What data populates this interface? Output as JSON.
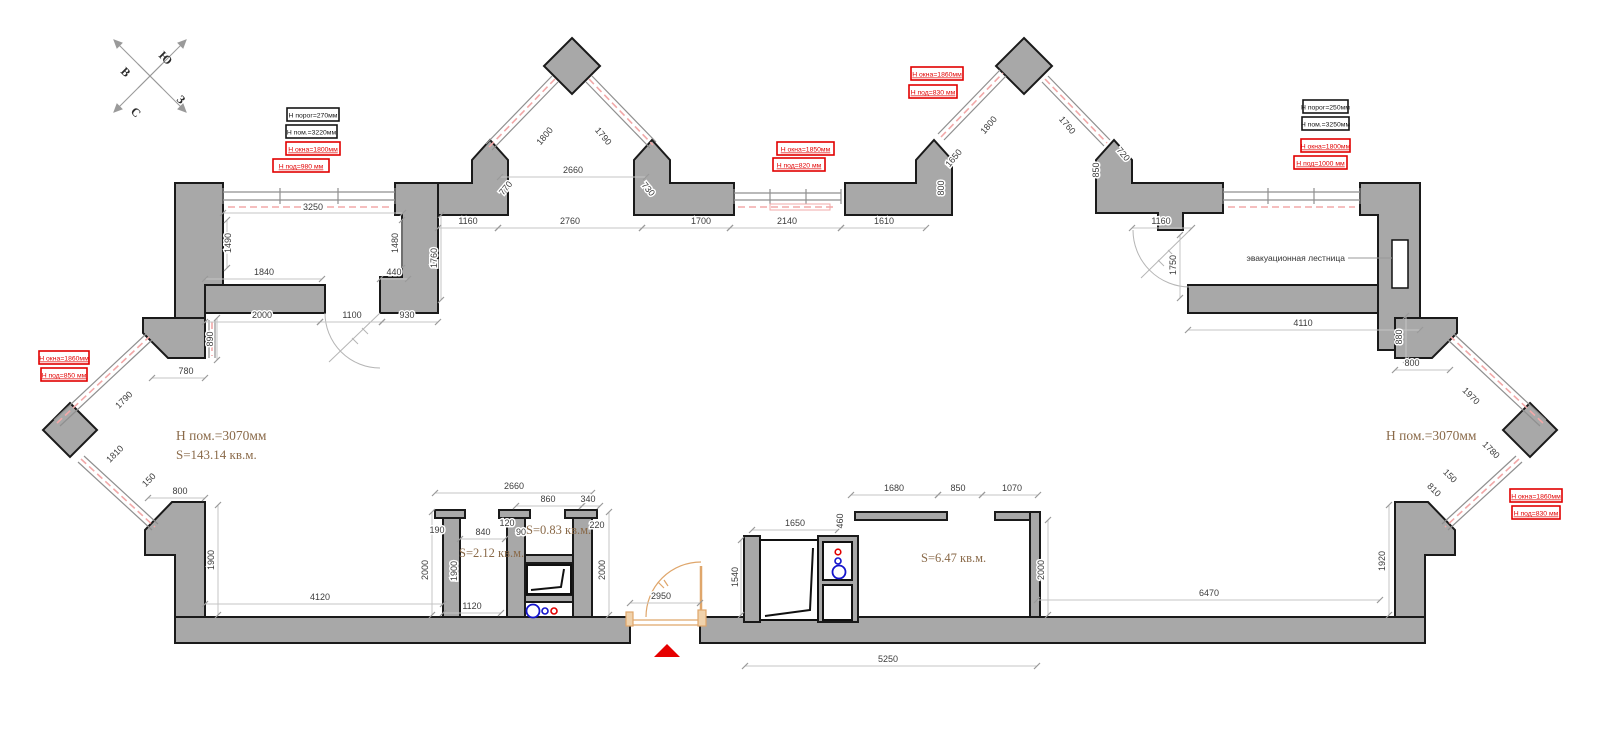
{
  "colors": {
    "wall_fill": "#a8a8a8",
    "wall_outline": "#1a1a1a",
    "dim_text": "#3c3c3c",
    "dim_line": "#c4c4c4",
    "annotation_red": "#e10000",
    "annotation_black": "#151515",
    "room_label_brown": "#8a6a49",
    "window_pink": "#f2a8a8",
    "entrance_orange": "#dfa66b",
    "plumbing_blue": "#1414cc",
    "plumbing_red": "#e10000",
    "entry_marker_red": "#e60000"
  },
  "compass": {
    "letters": [
      {
        "t": "В",
        "x": 120,
        "y": 72
      },
      {
        "t": "Ю",
        "x": 158,
        "y": 56
      },
      {
        "t": "С",
        "x": 130,
        "y": 112
      },
      {
        "t": "З",
        "x": 176,
        "y": 100
      }
    ]
  },
  "dimensions": [
    {
      "t": "3250",
      "x": 313,
      "y": 210,
      "l": [
        223,
        213,
        403,
        213
      ]
    },
    {
      "t": "1490",
      "x": 231,
      "y": 243,
      "r": -90,
      "l": [
        227,
        220,
        227,
        268
      ]
    },
    {
      "t": "1480",
      "x": 398,
      "y": 243,
      "r": -90,
      "l": [
        402,
        220,
        402,
        268
      ]
    },
    {
      "t": "1840",
      "x": 264,
      "y": 275,
      "l": [
        205,
        279,
        322,
        279
      ]
    },
    {
      "t": "440",
      "x": 394,
      "y": 275,
      "l": [
        380,
        279,
        408,
        279
      ]
    },
    {
      "t": "2000",
      "x": 262,
      "y": 318,
      "l": [
        205,
        322,
        320,
        322
      ]
    },
    {
      "t": "1100",
      "x": 352,
      "y": 318,
      "l": [
        320,
        322,
        382,
        322
      ]
    },
    {
      "t": "930",
      "x": 407,
      "y": 318,
      "l": [
        382,
        322,
        438,
        322
      ]
    },
    {
      "t": "890",
      "x": 213,
      "y": 339,
      "r": -90,
      "l": [
        217,
        318,
        217,
        360
      ]
    },
    {
      "t": "1760",
      "x": 437,
      "y": 258,
      "r": -90,
      "l": [
        441,
        215,
        441,
        300
      ]
    },
    {
      "t": "1160",
      "x": 468,
      "y": 224,
      "l": [
        438,
        228,
        498,
        228
      ]
    },
    {
      "t": "2760",
      "x": 570,
      "y": 224,
      "l": [
        498,
        228,
        642,
        228
      ]
    },
    {
      "t": "1700",
      "x": 701,
      "y": 224,
      "l": [
        642,
        228,
        730,
        228
      ]
    },
    {
      "t": "2140",
      "x": 787,
      "y": 224,
      "l": [
        730,
        228,
        841,
        228
      ]
    },
    {
      "t": "1610",
      "x": 884,
      "y": 224,
      "l": [
        841,
        228,
        926,
        228
      ]
    },
    {
      "t": "2660",
      "x": 573,
      "y": 173,
      "l": [
        500,
        177,
        646,
        177
      ]
    },
    {
      "t": "1800",
      "x": 547,
      "y": 138,
      "r": -50
    },
    {
      "t": "1790",
      "x": 601,
      "y": 138,
      "r": 50
    },
    {
      "t": "770",
      "x": 508,
      "y": 190,
      "r": -50
    },
    {
      "t": "730",
      "x": 646,
      "y": 191,
      "r": 50
    },
    {
      "t": "1650",
      "x": 956,
      "y": 160,
      "r": -50
    },
    {
      "t": "800",
      "x": 944,
      "y": 188,
      "r": -90
    },
    {
      "t": "1800",
      "x": 991,
      "y": 127,
      "r": -50
    },
    {
      "t": "1760",
      "x": 1065,
      "y": 127,
      "r": 50
    },
    {
      "t": "850",
      "x": 1099,
      "y": 170,
      "r": -90
    },
    {
      "t": "720",
      "x": 1121,
      "y": 156,
      "r": 50
    },
    {
      "t": "1160",
      "x": 1161,
      "y": 224,
      "l": [
        1132,
        228,
        1192,
        228
      ]
    },
    {
      "t": "1750",
      "x": 1176,
      "y": 265,
      "r": -90,
      "l": [
        1180,
        235,
        1180,
        298
      ]
    },
    {
      "t": "4110",
      "x": 1303,
      "y": 326,
      "l": [
        1188,
        330,
        1420,
        330
      ]
    },
    {
      "t": "880",
      "x": 1402,
      "y": 337,
      "r": -90,
      "l": [
        1406,
        316,
        1406,
        360
      ]
    },
    {
      "t": "780",
      "x": 186,
      "y": 374,
      "l": [
        152,
        378,
        205,
        378
      ]
    },
    {
      "t": "1790",
      "x": 126,
      "y": 402,
      "r": -45
    },
    {
      "t": "1810",
      "x": 117,
      "y": 456,
      "r": -45
    },
    {
      "t": "150",
      "x": 151,
      "y": 482,
      "r": -45
    },
    {
      "t": "800",
      "x": 180,
      "y": 494,
      "l": [
        148,
        498,
        205,
        498
      ]
    },
    {
      "t": "1900",
      "x": 214,
      "y": 560,
      "r": -90,
      "l": [
        218,
        505,
        218,
        615
      ]
    },
    {
      "t": "4120",
      "x": 320,
      "y": 600,
      "l": [
        205,
        604,
        443,
        604
      ]
    },
    {
      "t": "800",
      "x": 1412,
      "y": 366,
      "l": [
        1395,
        370,
        1450,
        370
      ]
    },
    {
      "t": "1970",
      "x": 1469,
      "y": 398,
      "r": 45
    },
    {
      "t": "1780",
      "x": 1489,
      "y": 452,
      "r": 45
    },
    {
      "t": "150",
      "x": 1448,
      "y": 478,
      "r": 45
    },
    {
      "t": "810",
      "x": 1432,
      "y": 492,
      "r": 45
    },
    {
      "t": "1920",
      "x": 1385,
      "y": 561,
      "r": -90,
      "l": [
        1389,
        505,
        1389,
        615
      ]
    },
    {
      "t": "6470",
      "x": 1209,
      "y": 596,
      "l": [
        1037,
        600,
        1380,
        600
      ]
    },
    {
      "t": "2660",
      "x": 514,
      "y": 489,
      "l": [
        435,
        493,
        592,
        493
      ]
    },
    {
      "t": "860",
      "x": 548,
      "y": 502,
      "l": [
        516,
        506,
        582,
        506
      ]
    },
    {
      "t": "340",
      "x": 588,
      "y": 502,
      "l": [
        582,
        506,
        600,
        506
      ]
    },
    {
      "t": "190",
      "x": 437,
      "y": 533
    },
    {
      "t": "840",
      "x": 483,
      "y": 535,
      "l": [
        460,
        539,
        505,
        539
      ]
    },
    {
      "t": "120",
      "x": 507,
      "y": 526
    },
    {
      "t": "90",
      "x": 521,
      "y": 535
    },
    {
      "t": "220",
      "x": 597,
      "y": 528
    },
    {
      "t": "2000",
      "x": 428,
      "y": 570,
      "r": -90,
      "l": [
        432,
        512,
        432,
        615
      ]
    },
    {
      "t": "1900",
      "x": 457,
      "y": 571,
      "r": -90
    },
    {
      "t": "2000",
      "x": 605,
      "y": 570,
      "r": -90,
      "l": [
        609,
        512,
        609,
        615
      ]
    },
    {
      "t": "1120",
      "x": 472,
      "y": 609,
      "l": [
        443,
        613,
        501,
        613
      ]
    },
    {
      "t": "2950",
      "x": 661,
      "y": 599,
      "l": [
        630,
        603,
        700,
        603
      ]
    },
    {
      "t": "1650",
      "x": 795,
      "y": 526,
      "l": [
        752,
        530,
        838,
        530
      ]
    },
    {
      "t": "460",
      "x": 843,
      "y": 521,
      "r": -90
    },
    {
      "t": "1540",
      "x": 738,
      "y": 577,
      "r": -90,
      "l": [
        741,
        540,
        741,
        615
      ]
    },
    {
      "t": "1680",
      "x": 894,
      "y": 491,
      "l": [
        851,
        495,
        938,
        495
      ]
    },
    {
      "t": "850",
      "x": 958,
      "y": 491,
      "l": [
        938,
        495,
        982,
        495
      ]
    },
    {
      "t": "1070",
      "x": 1012,
      "y": 491,
      "l": [
        982,
        495,
        1038,
        495
      ]
    },
    {
      "t": "2000",
      "x": 1044,
      "y": 570,
      "r": -90,
      "l": [
        1048,
        520,
        1048,
        615
      ]
    },
    {
      "t": "5250",
      "x": 888,
      "y": 662,
      "l": [
        745,
        666,
        1037,
        666
      ]
    }
  ],
  "annotations": [
    {
      "t": "Н порог=270мм",
      "x": 287,
      "y": 108,
      "w": 52,
      "c": "black"
    },
    {
      "t": "Н пом.=3220мм",
      "x": 286,
      "y": 125,
      "w": 51,
      "c": "black"
    },
    {
      "t": "Н окна=1800мм",
      "x": 286,
      "y": 142,
      "w": 54,
      "c": "red"
    },
    {
      "t": "Н под=980 мм",
      "x": 273,
      "y": 159,
      "w": 56,
      "c": "red"
    },
    {
      "t": "Н окна=1850мм",
      "x": 777,
      "y": 142,
      "w": 57,
      "c": "red"
    },
    {
      "t": "Н под=820 мм",
      "x": 773,
      "y": 158,
      "w": 52,
      "c": "red"
    },
    {
      "t": "Н окна=1860мм",
      "x": 911,
      "y": 67,
      "w": 52,
      "c": "red"
    },
    {
      "t": "Н под=830 мм",
      "x": 909,
      "y": 85,
      "w": 48,
      "c": "red"
    },
    {
      "t": "Н порог=250мм",
      "x": 1303,
      "y": 100,
      "w": 45,
      "c": "black"
    },
    {
      "t": "Н пом.=3250мм",
      "x": 1302,
      "y": 117,
      "w": 47,
      "c": "black"
    },
    {
      "t": "Н окна=1800мм",
      "x": 1301,
      "y": 139,
      "w": 49,
      "c": "red"
    },
    {
      "t": "Н под=1000 мм",
      "x": 1294,
      "y": 156,
      "w": 53,
      "c": "red"
    },
    {
      "t": "Н окна=1860мм",
      "x": 39,
      "y": 351,
      "w": 50,
      "c": "red"
    },
    {
      "t": "Н под=850 мм",
      "x": 41,
      "y": 368,
      "w": 46,
      "c": "red"
    },
    {
      "t": "Н окна=1860мм",
      "x": 1510,
      "y": 489,
      "w": 52,
      "c": "red"
    },
    {
      "t": "Н под=830 мм",
      "x": 1512,
      "y": 506,
      "w": 48,
      "c": "red"
    }
  ],
  "room_labels": [
    {
      "t": "Н пом.=3070мм",
      "x": 176,
      "y": 440,
      "s": 13.5
    },
    {
      "t": "S=143.14 кв.м.",
      "x": 176,
      "y": 459,
      "s": 13
    },
    {
      "t": "Н пом.=3070мм",
      "x": 1386,
      "y": 440,
      "s": 13.5
    },
    {
      "t": "S=2.12 кв.м.",
      "x": 459,
      "y": 557,
      "s": 12.5
    },
    {
      "t": "S=0.83 кв.м.",
      "x": 526,
      "y": 534,
      "s": 12.5
    },
    {
      "t": "S=6.47 кв.м.",
      "x": 921,
      "y": 562,
      "s": 12.5
    }
  ],
  "notes": [
    {
      "t": "эвакуационная лестница",
      "x": 1345,
      "y": 261,
      "leader": [
        1348,
        258,
        1392,
        258
      ]
    }
  ]
}
